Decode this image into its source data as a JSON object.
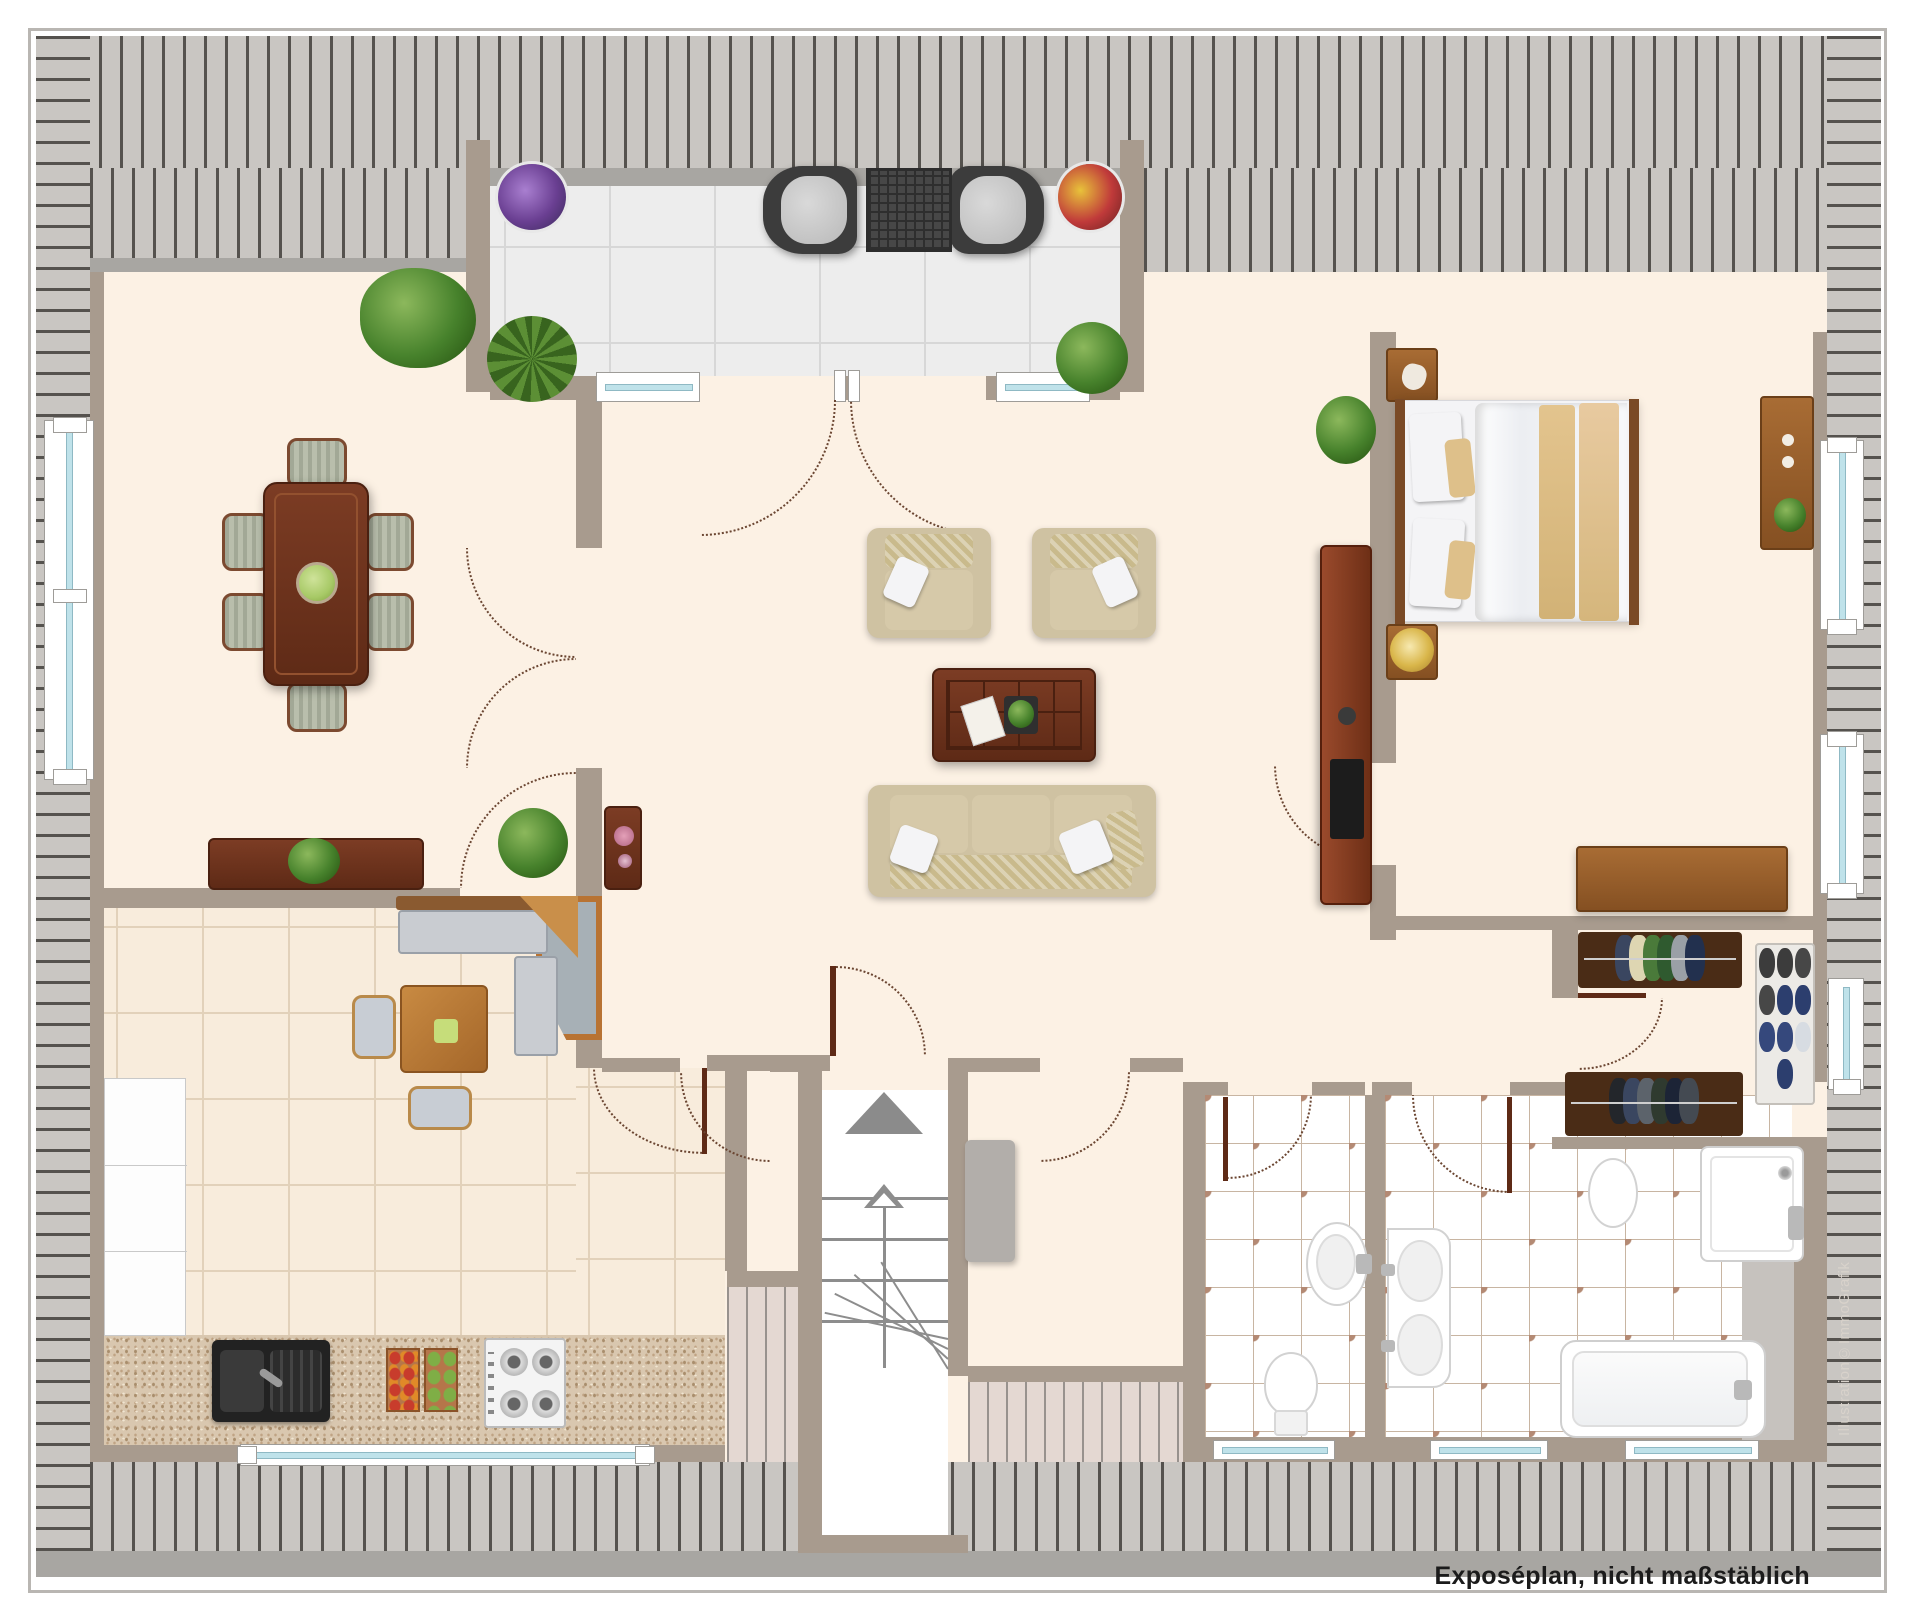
{
  "meta": {
    "caption": "Exposéplan, nicht maßstäblich",
    "watermark": "Illustration©ImmoGrafik"
  },
  "palette": {
    "floor_cream": "#FCF1E4",
    "wall_taupe": "#A89B8E",
    "roof_slat": "#C9C6C2",
    "roof_slat_line": "#55524E",
    "roof_slat_low": "#E4D8D2",
    "eaves_bar": "#A8A6A2",
    "terrace_tile": "#EDEDED",
    "kitchen_tile": "#F8ECDC",
    "kitchen_counter": "#D9C7AF",
    "bath_tile": "#FFFFFF",
    "bath_diamond": "#B48A74",
    "wood_dark": "#6E3420",
    "wood_mid": "#9A6430",
    "upholstery_beige": "#CFC2A2",
    "bed_linen": "#F4F4F6",
    "bed_runner": "#DEC08A",
    "window_glazing": "#BFE2EA",
    "door_arc": "#6B4632",
    "caption_text": "#1B1B1B",
    "watermark_text": "#D8D2CB"
  },
  "furniture_icons": [
    "dining-table",
    "dining-chair",
    "fruit-bowl",
    "monstera-plant",
    "yucca-plant",
    "potted-plant",
    "sideboard",
    "flower-table",
    "armchair",
    "coffee-table",
    "sofa",
    "tv-lowboard",
    "double-bed",
    "nightstand",
    "table-lamp",
    "dresser",
    "clothes-rack",
    "shoe-rack",
    "corner-bench",
    "kitchen-table",
    "kitchen-chair",
    "kitchen-counter",
    "kitchen-sink",
    "gas-stove",
    "vegetable-crates",
    "kitchen-cabinets",
    "staircase",
    "up-arrow",
    "entry-wardrobe",
    "pedestal-sink",
    "toilet",
    "double-washbasin",
    "shower",
    "bathtub",
    "terrace-chair",
    "terrace-table",
    "flower-pot-purple",
    "flower-pot-red"
  ]
}
